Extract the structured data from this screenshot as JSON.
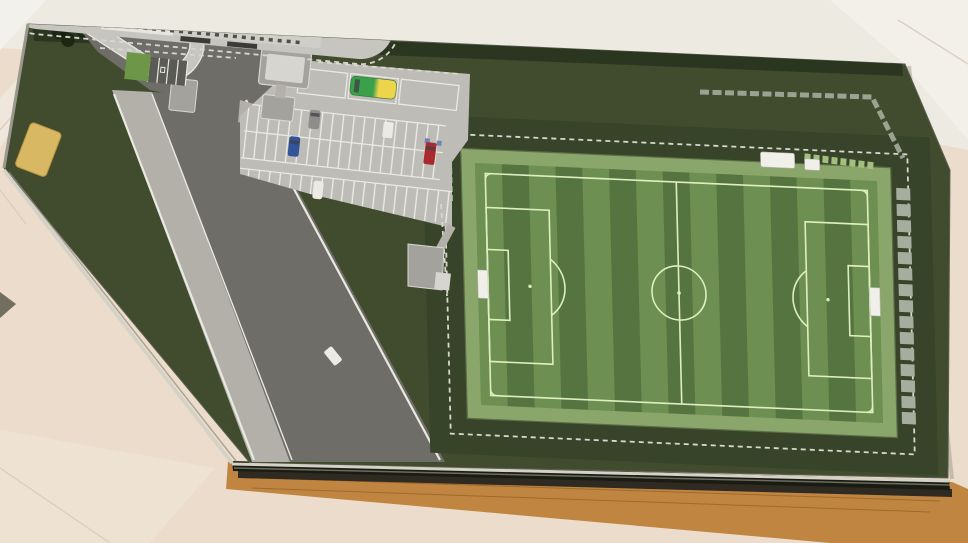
{
  "meta": {
    "description": "Overhead photograph of an architectural scale model of a football training ground - striped pitch with white markings, grandstand with ribbed metal roof, striped car park with toy vehicles and a diagonal access road - mounted on a dark green board with a wooden display frame, standing on a beige marble floor"
  },
  "colors": {
    "floor_base": "#ecdccb",
    "floor_top": "#edeae2",
    "floor_bright": "#f3f1eb",
    "floor_pink": "#eee2d3",
    "floor_seam": "#d8cdbc",
    "wood": "#c18542",
    "wood_dark": "#7c4f17",
    "wood_slot": "#2f2a22",
    "glass_edge": "#d4d1c7",
    "board_green": "#414c2e",
    "board_stroke": "#5f6052",
    "hedge_green": "#2b3620",
    "tree_green": "#1d2813",
    "apron_green": "#38442a",
    "bright_patch": "#6d9747",
    "road_asphalt": "#6f6d68",
    "road_line": "#e9e8e1",
    "sidewalk": "#b2b0a9",
    "lot_gray": "#bdbcb7",
    "stall_line": "#edece6",
    "loop_gray": "#c6c5c0",
    "kiosk_gray": "#a3a29c",
    "kiosk_roof": "#d6d5d0",
    "stand_roof": "#b7b6b2",
    "stand_roof_hl": "#d9d8d4",
    "stand_ridge": "#98978f",
    "stand_vent": "#4c4b47",
    "stand_plinth": "#cfcec9",
    "facade_white": "#e6e5df",
    "window_dark": "#504f4b",
    "fence_dash": "#d7d6cf",
    "pitch_light": "#6d8f52",
    "pitch_dark": "#567440",
    "pitch_line": "#dfeec1",
    "pitch_walkway": "#8aa66a",
    "walkway_edge": "#5d6d48",
    "panel_green": "#a3bf7d",
    "terrace_gray": "#a4ad9e",
    "goal_white": "#f0efe9",
    "plaque_gold": "#d9b863",
    "plaque_border": "#b8953f",
    "disabled_bay": "#5b5b55",
    "sign_blue": "#7284b4",
    "bus_green": "#3aa04a",
    "bus_yellow": "#edd44b",
    "car_grey": "#8f8e8a",
    "car_blue": "#31549a",
    "car_red": "#a82a2e",
    "car_white": "#ebeae5"
  },
  "objects": {
    "floor": {
      "label": "beige marble floor with tile seams"
    },
    "display_base": {
      "label": "wooden display frame with dark glass slot"
    },
    "site_board": {
      "label": "dark green model board, corner cut along the road"
    },
    "plaque": {
      "label": "gold name plaque on the grass verge"
    },
    "road": {
      "label": "diagonal access road with white edge lines and footpath"
    },
    "entrance": {
      "label": "gatehouse kiosks and drop-off loop at the site entrance"
    },
    "car_park": {
      "label": "car park with white-striped stalls",
      "stall_rows": 3,
      "bus_bays": 3,
      "accessible_bays": 3
    },
    "vehicles": [
      {
        "name": "coach-bus",
        "location": "bus bay",
        "color_front": "green",
        "color_rear": "yellow"
      },
      {
        "name": "grey-car",
        "location": "car park"
      },
      {
        "name": "blue-car",
        "location": "car park"
      },
      {
        "name": "white-van",
        "location": "car park"
      },
      {
        "name": "red-van",
        "location": "car park"
      },
      {
        "name": "white-car",
        "location": "car park edge"
      },
      {
        "name": "white-van-on-road",
        "location": "access road"
      }
    ],
    "grandstand": {
      "label": "grandstand with ribbed metal roof, roof vents, window facade and dugouts, inside a ring road with green islands"
    },
    "pitch": {
      "label": "full-size football pitch",
      "mow_stripes": 15,
      "markings": [
        "touchlines",
        "goal lines",
        "halfway line",
        "centre circle",
        "centre spot",
        "penalty areas",
        "goal areas",
        "penalty spots",
        "penalty arcs",
        "corner arcs"
      ],
      "goals": 2,
      "surround": "light walkway, dashed perimeter fence, segmented terrace wall on the far side, light green corner panels"
    },
    "trees": {
      "label": "tree cluster at the north-west corner",
      "count": 6
    },
    "outbuilding": {
      "label": "small L-shaped outbuilding between road and pitch"
    }
  }
}
